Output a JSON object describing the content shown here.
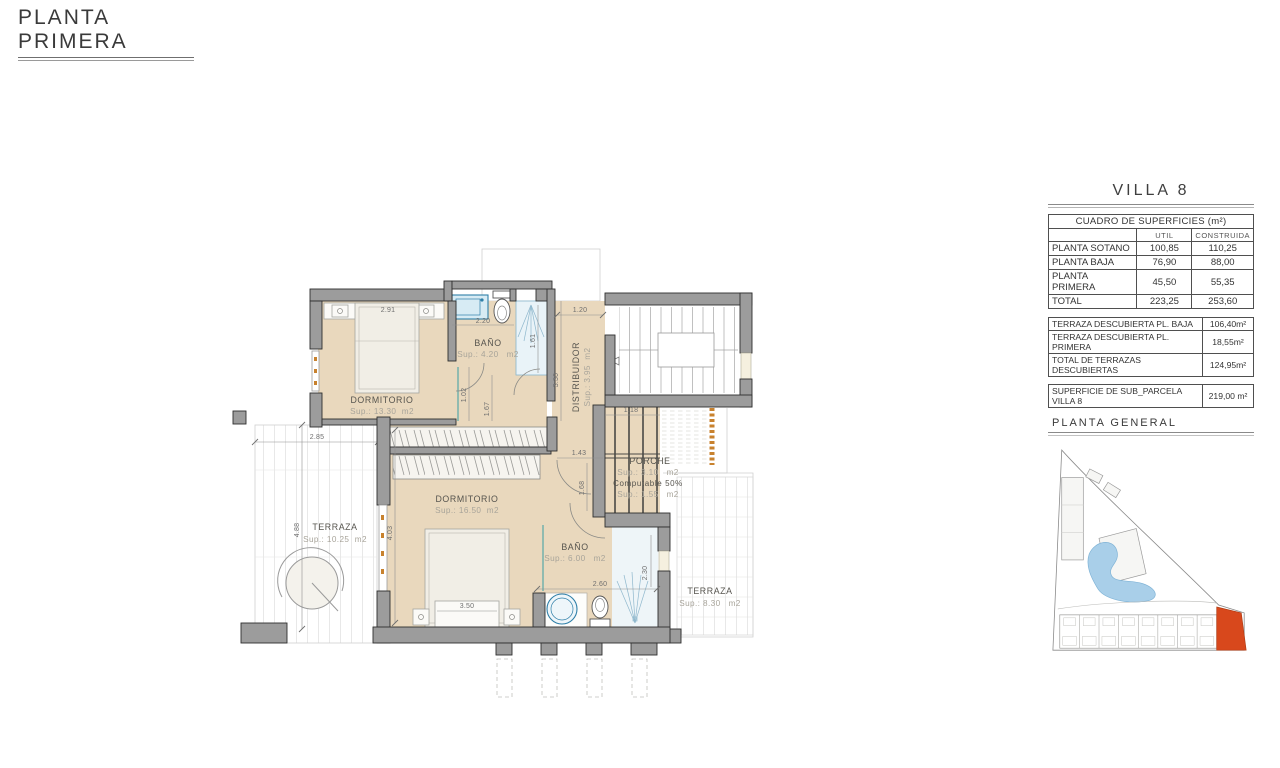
{
  "title": "PLANTA PRIMERA",
  "panel": {
    "villa": "VILLA 8",
    "surfaces": {
      "title": "CUADRO DE SUPERFICIES (m²)",
      "columns": {
        "util": "UTIL",
        "construida": "CONSTRUIDA"
      },
      "rows": [
        {
          "label": "PLANTA SOTANO",
          "util": "100,85",
          "construida": "110,25"
        },
        {
          "label": "PLANTA BAJA",
          "util": "76,90",
          "construida": "88,00"
        },
        {
          "label": "PLANTA PRIMERA",
          "util": "45,50",
          "construida": "55,35"
        },
        {
          "label": "TOTAL",
          "util": "223,25",
          "construida": "253,60"
        }
      ]
    },
    "terraces": [
      {
        "label": "TERRAZA DESCUBIERTA PL. BAJA",
        "value": "106,40m²"
      },
      {
        "label": "TERRAZA DESCUBIERTA PL. PRIMERA",
        "value": "18,55m²"
      },
      {
        "label": "TOTAL DE TERRAZAS DESCUBIERTAS",
        "value": "124,95m²"
      }
    ],
    "parcel": {
      "label": "SUPERFICIE DE SUB_PARCELA VILLA 8",
      "value": "219,00 m²"
    },
    "site_plan_title": "PLANTA  GENERAL"
  },
  "plan": {
    "rooms": {
      "dorm1": {
        "name": "DORMITORIO",
        "sup": "Sup.: 13.30  m2"
      },
      "bath1": {
        "name": "BAÑO",
        "sup": "Sup.: 4.20   m2"
      },
      "distribuidor": {
        "name": "DISTRIBUIDOR",
        "sup": "Sup.: 3.95  m2"
      },
      "dorm2": {
        "name": "DORMITORIO",
        "sup": "Sup.: 16.50  m2"
      },
      "bath2": {
        "name": "BAÑO",
        "sup": "Sup.: 6.00   m2"
      },
      "porche": {
        "name": "PORCHE",
        "sup": "Sup.: 3.10   m2",
        "note": "Computable 50%",
        "sup2": "Sup.: 1.55   m2"
      },
      "terrace1": {
        "name": "TERRAZA",
        "sup": "Sup.: 10.25  m2"
      },
      "terrace2": {
        "name": "TERRAZA",
        "sup": "Sup.: 8.30   m2"
      }
    },
    "dims": {
      "d291": "2.91",
      "d220": "2.20",
      "d120": "1.20",
      "d161": "1.61",
      "d330": "3.30",
      "d102": "1.02",
      "d167": "1.67",
      "d143": "1.43",
      "d118": "1.18",
      "d168": "1.68",
      "d285": "2.85",
      "d488": "4.88",
      "d403": "4.03",
      "d350": "3.50",
      "d260": "2.60",
      "d230": "2.30"
    }
  },
  "colors": {
    "floor_tan": "#e9d8bd",
    "wall_gray": "#9c9c9c",
    "fixture_blue": "#2e7fa8",
    "window_orange": "#c8822e",
    "lagoon_blue": "#a9cfe9",
    "villa_highlight": "#d8481c"
  }
}
